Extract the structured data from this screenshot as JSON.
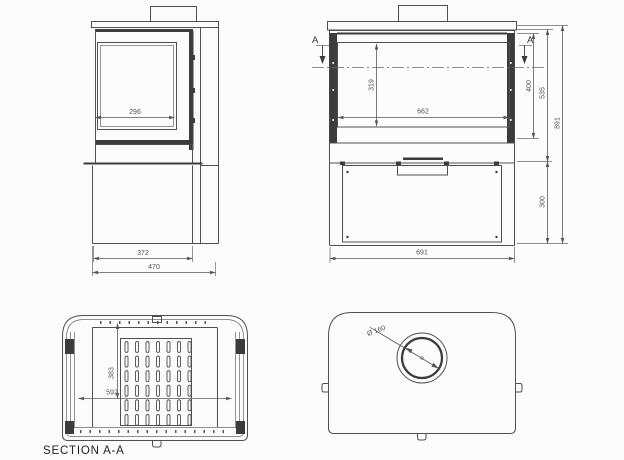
{
  "drawing": {
    "caption": "SECTION A-A",
    "section_marker": "A",
    "side_view": {
      "dim_glass_depth": "296",
      "dim_body_depth": "372",
      "dim_total_depth": "470"
    },
    "front_view": {
      "dim_glass_height": "319",
      "dim_glass_width": "662",
      "dim_door_height": "400",
      "dim_upper_height": "535",
      "dim_total_height": "891",
      "dim_base_height": "300",
      "dim_total_width": "691"
    },
    "section_view": {
      "dim_inner_depth": "383",
      "dim_inner_width": "592"
    },
    "top_view": {
      "dim_flue_diameter": "Ø 160"
    },
    "line_color": "#4f4f4f",
    "dark_color": "#3c3c3c",
    "dim_color": "#555555",
    "background": "#fcfcfc"
  }
}
